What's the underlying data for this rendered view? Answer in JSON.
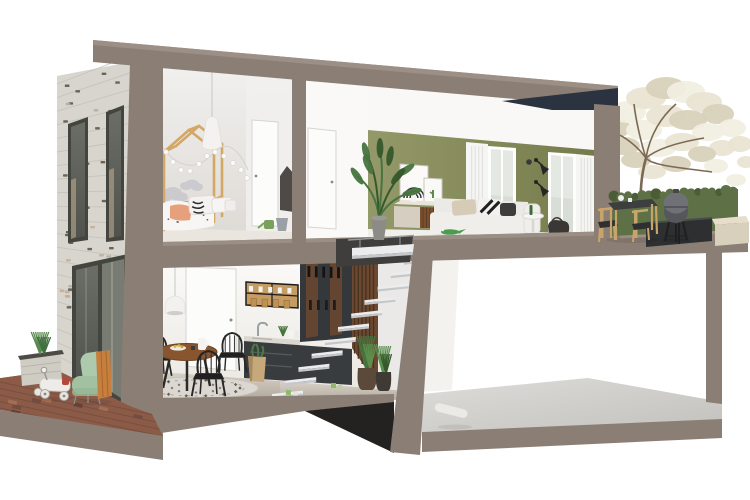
{
  "scene": {
    "description": "Cutaway 3D cross-section rendering of a modern split-level house: children's bedroom and green-walled living room upstairs, kitchen-dining room with floating stairs downstairs, empty basement slab, speckled brick facade with front yard (toy car, mint armchair, planter), and a roof terrace with blossoming tree, hedge, kamado grill and wooden dining set."
  },
  "colors": {
    "background": "#ffffff",
    "cut_wall": "#8b7e74",
    "cut_wall_light": "#9d9187",
    "cut_wall_dark": "#75695f",
    "roof_dark": "#2b3240",
    "brick_base": "#d8d5ce",
    "brick_line": "#c4c0b7",
    "brick_dark": "#5e584e",
    "brick_warm": "#c3ae92",
    "window_frame": "#45453f",
    "glass_dark": "#53564e",
    "bedroom_wall": "#e3e0dc",
    "door_white": "#fcfcfb",
    "cloud": "#cbcacf",
    "wood_light": "#d4a765",
    "peach": "#e6a07b",
    "green_wall": "#888d5d",
    "green_wall_dark": "#737849",
    "curtain": "#f5f5f3",
    "sofa": "#f0eeea",
    "pillow_beige": "#d5cbb6",
    "charcoal": "#262626",
    "plant_green": "#47743f",
    "plant_green_dark": "#35592c",
    "pot_gray": "#8d8b86",
    "sideboard_beige": "#d6cfc1",
    "sideboard_wood": "#7a4f2e",
    "kitchen_floor": "#c2bab0",
    "kitchen_floor_light": "#dcd5cb",
    "cabinet_dark": "#393c3e",
    "counter_light": "#dad7d1",
    "shelf_wood": "#bf9254",
    "table_wood": "#88552f",
    "stair_tread": "#ebeced",
    "stair_tread_side": "#c5c7c9",
    "slat_wood": "#6b4830",
    "slat_gap": "#49311f",
    "rug": "#dcd8d1",
    "rug_dark": "#3b3936",
    "paving": "#8c5b48",
    "paving_dark": "#5e4037",
    "paving_light": "#a97257",
    "mint_chair": "#adcaac",
    "blanket_orange": "#c77f3e",
    "toy_white": "#eeece8",
    "concrete": "#c8c7c3",
    "concrete_light": "#dddcd8",
    "hedge": "#5d7046",
    "hedge_dark": "#4b5c37",
    "tree_foliage": "#e9e4d2",
    "tree_foliage_dark": "#d8d1ba",
    "tree_trunk": "#7c6954",
    "grill_body": "#707176",
    "grill_dark": "#56575c",
    "terrace_black": "#2d2f31",
    "stone_block": "#d8cfbc",
    "bag_tan": "#c7a87b",
    "stair_void": "#403e3c",
    "under_house_shadow": "#232220"
  }
}
